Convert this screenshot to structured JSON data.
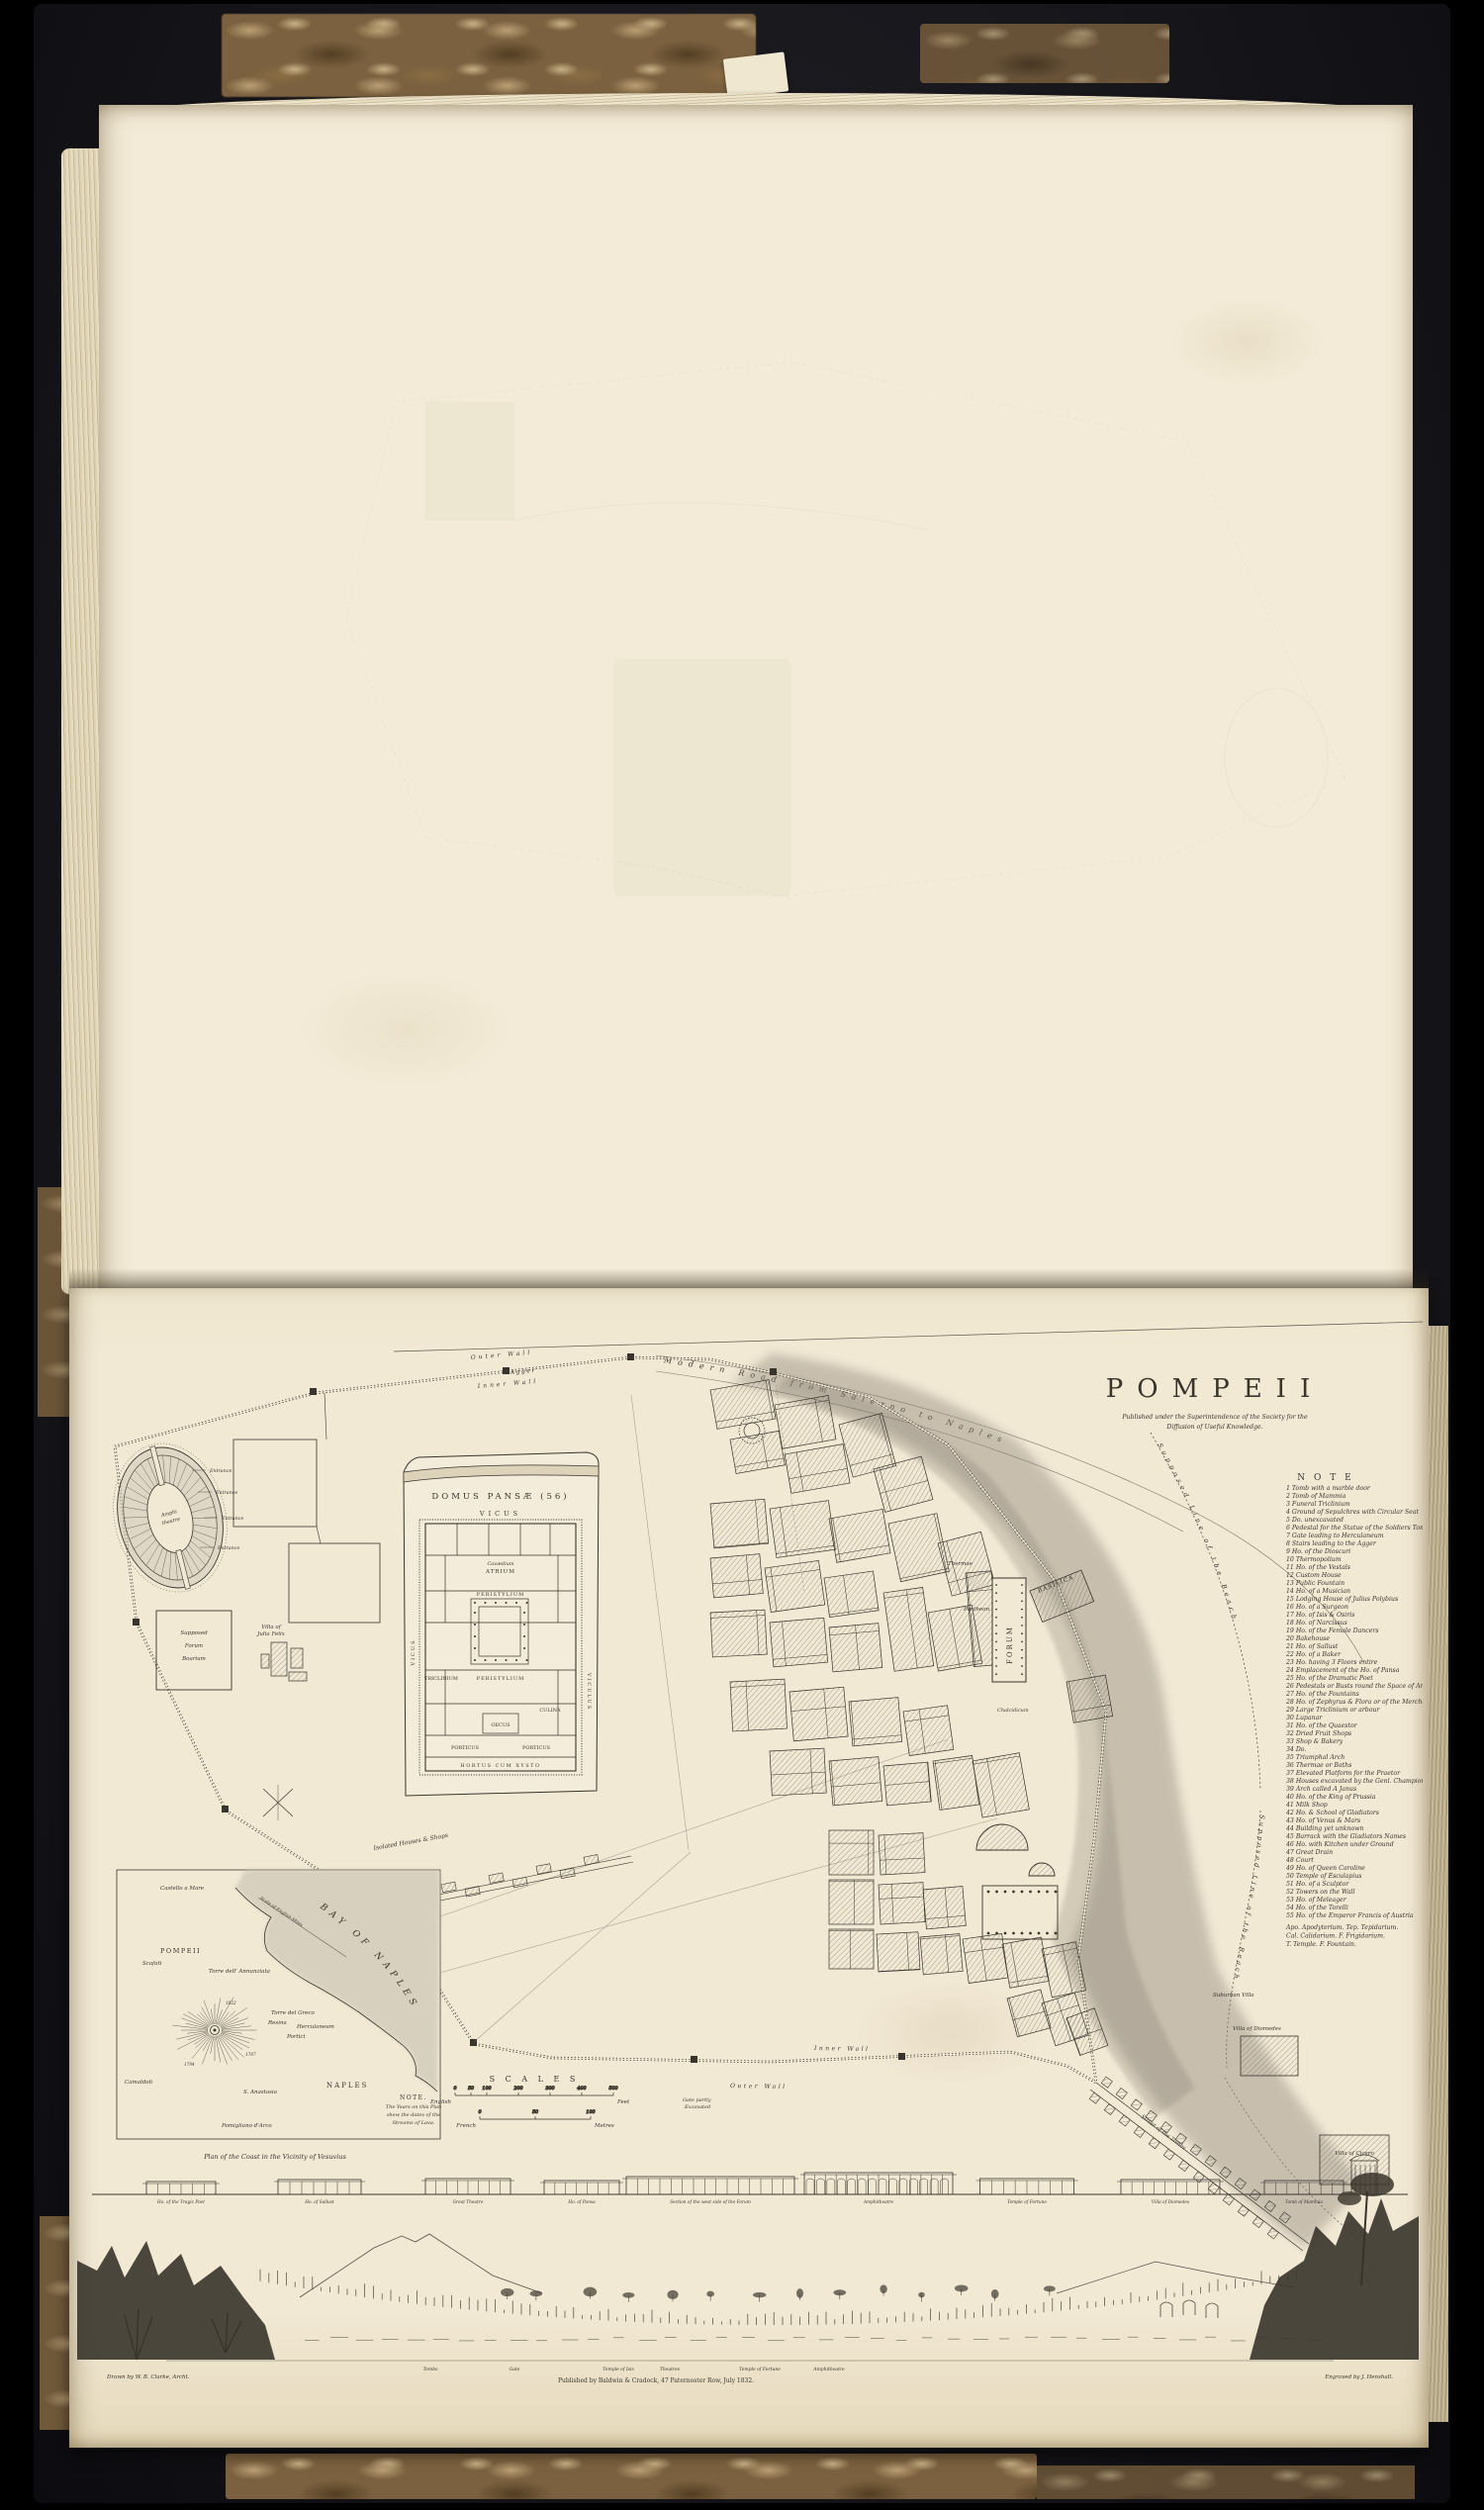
{
  "colors": {
    "background": "#000000",
    "cover": "#17171c",
    "marble_light": "#bba075",
    "marble_dark": "#533e24",
    "page": "#f2e9d5",
    "ink": "#3a352c",
    "ink_light": "#6d665a",
    "wash": "#9a9184"
  },
  "plate": {
    "title": "POMPEII",
    "subtitle_line1": "Published under the Superintendence of the Society for the",
    "subtitle_line2": "Diffusion of Useful Knowledge.",
    "note": {
      "header": "N O T E",
      "items": [
        "1 Tomb with a marble door",
        "2 Tomb of Mammia",
        "3 Funeral Triclinium",
        "4 Ground of Sepulchres with Circular Seat",
        "5 Do. unexcavated",
        "6 Pedestal for the Statue of the Soldiers Tomb",
        "7 Gate leading to Herculaneum",
        "8 Stairs leading to the Agger",
        "9 Ho. of the Dioscuri",
        "10 Thermopolium",
        "11 Ho. of the Vestals",
        "12 Custom House",
        "13 Public Fountain",
        "14 Ho. of a Musician",
        "15 Lodging House of Julius Polybius",
        "16 Ho. of a Surgeon",
        "17 Ho. of Isis & Osiris",
        "18 Ho. of Narcissus",
        "19 Ho. of the Female Dancers",
        "20 Bakehouse",
        "21 Ho. of Sallust",
        "22 Ho. of a Baker",
        "23 Ho. having 3 Floors entire",
        "24 Emplacement of the Ho. of Pansa",
        "25 Ho. of the Dramatic Poet",
        "26 Pedestals or Busts round the Space of Amusements",
        "27 Ho. of the Fountains",
        "28 Ho. of Zephyrus & Flora or of the Merchants",
        "29 Large Triclinium or arbour",
        "30 Lupanar",
        "31 Ho. of the Quaestor",
        "32 Dried Fruit Shops",
        "33 Shop & Bakery",
        "34 Do.",
        "35 Triumphal Arch",
        "36 Thermae or Baths",
        "37 Elevated Platform for the Praetor",
        "38 Houses excavated by the Genl. Championnet",
        "39 Arch called A Janus",
        "40 Ho. of the King of Prussia",
        "41 Milk Shop",
        "42 Ho. & School of Gladiators",
        "43 Ho. of Venus & Mars",
        "44 Building yet unknown",
        "45 Barrack with the Gladiators Names",
        "46 Ho. with Kitchen under Ground",
        "47 Great Drain",
        "48 Court",
        "49 Ho. of Queen Caroline",
        "50 Temple of Esculapius",
        "51 Ho. of a Sculptor",
        "52 Towers on the Wall",
        "53 Ho. of Meleager",
        "54 Ho. of the Torelli",
        "55 Ho. of the Emperor Francis of Austria"
      ],
      "abbreviations": [
        "Apo. Apodyterium.   Tep. Tepidarium.",
        "Cal. Calidarium.   F. Frigidarium.",
        "T. Temple.   F. Fountain."
      ]
    },
    "walls": {
      "outer": "Outer Wall",
      "agger": "Agger",
      "inner": "Inner Wall",
      "modern_road": "Modern Road from Salerno to Naples",
      "beach_line": "Supposed Line of the Beach",
      "inner_south": "Inner Wall",
      "outer_south": "Outer Wall",
      "gate_partly": "Gate partly",
      "excavated": "Excavated"
    },
    "features": {
      "amphitheatre_1": "Amphi",
      "amphitheatre_2": "theatre",
      "entrance": "Entrance",
      "forum_boarium_1": "Supposed",
      "forum_boarium_2": "Forum",
      "forum_boarium_3": "Boarium",
      "villa_julia_1": "Villa of",
      "villa_julia_2": "Julia Felix",
      "isolated_houses": "Isolated Houses & Shops",
      "forum": "FORUM",
      "basilica": "BASILICA",
      "pantheon": "Pantheon",
      "chalcidicum": "Chalcidicum",
      "thermae": "Thermae",
      "street_of_tombs": "Street of the Tombs",
      "suburban_villa": "Suburban Villa",
      "villa_diomedes": "Villa of Diomedes",
      "villa_cicero": "Villa of Cicero"
    },
    "domus": {
      "title": "DOMUS PANSÆ (56)",
      "vicus": "VICUS",
      "viculus": "VICULUS",
      "atrium": "ATRIUM",
      "cavaedium": "Cavædium",
      "peristylium": "PERISTYLIUM",
      "triclinium": "TRICLINIUM",
      "oecus": "OECUS",
      "culina": "CULINA",
      "porticus_l": "PORTICUS",
      "porticus_r": "PORTICUS",
      "hortus": "HORTUS  CUM  XYSTO"
    },
    "bay": {
      "title": "BAY OF NAPLES",
      "pompeii": "POMPEII",
      "naples": "NAPLES",
      "castellamare": "Castello a Mare",
      "scafati": "Scafati",
      "annunziata": "Torre dell' Annunziata",
      "torre_greco": "Torre del Greco",
      "resina": "Resina",
      "portici": "Portici",
      "herculaneum": "Herculaneum",
      "s_anastasia": "S. Anastasia",
      "camaldoli": "Camaldoli",
      "pomigliano": "Pomigliano d'Arco",
      "scale_label": "Scale of English Miles",
      "lava_years": [
        "1767",
        "1794",
        "1822"
      ],
      "note_title": "NOTE.",
      "note_lines": [
        "The Years on this Plan",
        "shew the dates of the",
        "Streams of Lava."
      ],
      "caption": "Plan of the Coast in the Vicinity of Vesuvius"
    },
    "scales": {
      "header": "S C A L E S",
      "english_left": "English",
      "english_right": "Feet",
      "english_ticks": [
        "0",
        "50",
        "100",
        "200",
        "300",
        "400",
        "500"
      ],
      "french_left": "French",
      "french_right": "Metres",
      "french_ticks": [
        "0",
        "50",
        "100"
      ]
    },
    "elevations": {
      "captions": [
        "Ho. of the Tragic Poet",
        "Ho. of Sallust",
        "Great Theatre",
        "Ho. of Pansa",
        "Section of the west side of the Forum",
        "Amphitheatre",
        "Temple of Fortune",
        "Villa of Diomedes",
        "Tomb of Mammia"
      ]
    },
    "panorama": {
      "labels": [
        "Tombs",
        "Gate",
        "Temple of Isis",
        "Theatres",
        "Temple of Fortune",
        "Amphitheatre"
      ]
    },
    "imprint": "Published by Baldwin & Cradock, 47 Paternoster Row, July 1832.",
    "credit_left": "Drawn by W. B. Clarke, Archt.",
    "credit_right": "Engraved by J. Henshall."
  }
}
